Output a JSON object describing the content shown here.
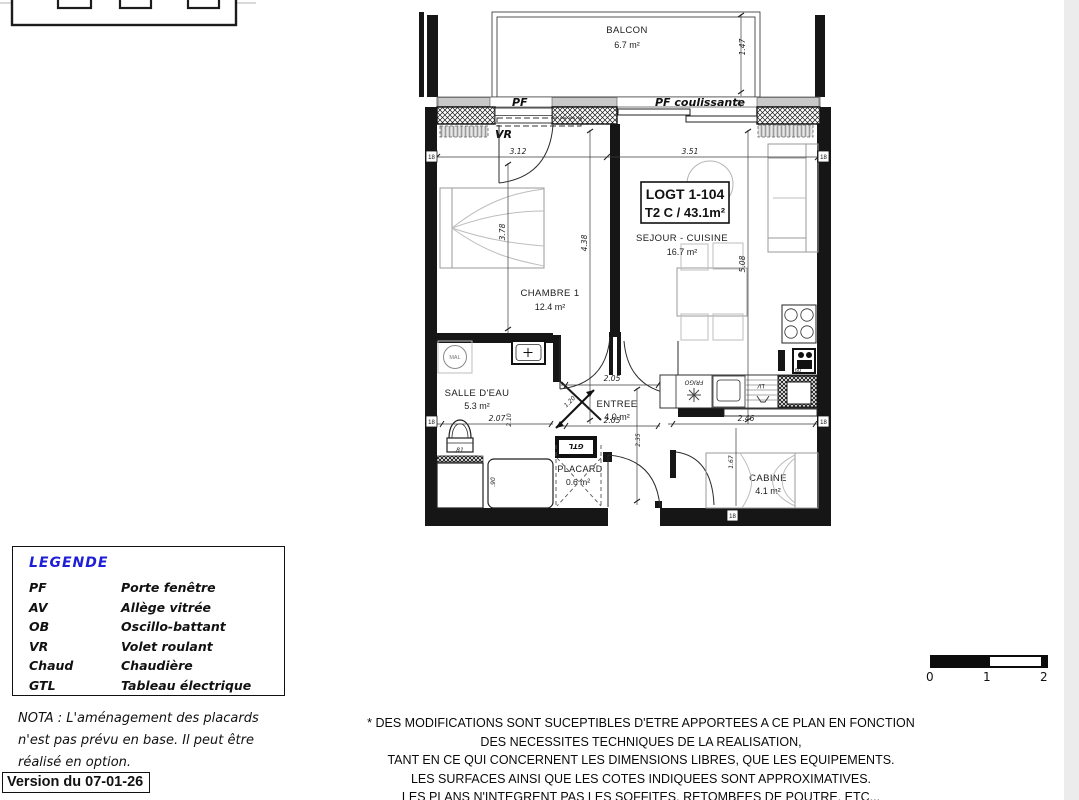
{
  "plan": {
    "title_box": {
      "line1": "LOGT 1-104",
      "line2": "T2 C / 43.1m²"
    },
    "rooms": {
      "balcon": {
        "name": "BALCON",
        "area": "6.7 m²"
      },
      "sejour": {
        "name": "SEJOUR - CUISINE",
        "area": "16.7 m²"
      },
      "chambre": {
        "name": "CHAMBRE 1",
        "area": "12.4 m²"
      },
      "salle_eau": {
        "name": "SALLE D'EAU",
        "area": "5.3 m²"
      },
      "entree": {
        "name": "ENTREE",
        "area": "4.0 m²"
      },
      "placard": {
        "name": "PLACARD",
        "area": "0.6 m²"
      },
      "cabine": {
        "name": "CABINE",
        "area": "4.1 m²"
      }
    },
    "annotations": {
      "pf": "PF",
      "pf_coulissante": "PF coulissante",
      "vr": "VR",
      "mal": "MAL",
      "gtl": "GTL",
      "frigo": "FRIGO",
      "lv": "LV",
      "chaud": "60",
      "wall_mark": "18"
    },
    "dims": {
      "balcon_h": "1.47",
      "balcon_s": "34",
      "chambre_w": "3.12",
      "sejour_w": "3.51",
      "chambre_h": "3.78",
      "left_h": "4.38",
      "sejour_h": "5.08",
      "sdb_w": "2.07",
      "sdb_h": "2.10",
      "entree_w1": "2.05",
      "entree_w2": "2.05",
      "entree_h": "2.35",
      "entree_diag": "1.20",
      "cabine_w": "2.46",
      "cabine_h": "1.67",
      "wc": ".81",
      "douche": ".90"
    }
  },
  "legend": {
    "title": "LEGENDE",
    "items": [
      {
        "abbr": "PF",
        "label": "Porte fenêtre"
      },
      {
        "abbr": "AV",
        "label": "Allège vitrée"
      },
      {
        "abbr": "OB",
        "label": "Oscillo-battant"
      },
      {
        "abbr": "VR",
        "label": "Volet roulant"
      },
      {
        "abbr": "Chaud",
        "label": "Chaudière"
      },
      {
        "abbr": "GTL",
        "label": "Tableau électrique"
      }
    ]
  },
  "nota": {
    "line1": "NOTA : L'aménagement des placards",
    "line2": "n'est pas prévu en base. Il peut être",
    "line3": "réalisé en option."
  },
  "version": {
    "label": "Version du 07-01-26"
  },
  "disclaimer": {
    "line1": "* DES MODIFICATIONS SONT SUCEPTIBLES D'ETRE APPORTEES A CE PLAN EN FONCTION",
    "line2": "DES NECESSITES TECHNIQUES DE LA REALISATION,",
    "line3": "TANT EN CE QUI CONCERNENT LES DIMENSIONS LIBRES, QUE LES EQUIPEMENTS.",
    "line4": "LES SURFACES AINSI QUE LES COTES INDIQUEES SONT APPROXIMATIVES.",
    "line5": "LES PLANS N'INTEGRENT PAS LES SOFFITES, RETOMBEES DE POUTRE, ETC..."
  },
  "scale_bar": {
    "t0": "0",
    "t1": "1",
    "t2": "2"
  }
}
